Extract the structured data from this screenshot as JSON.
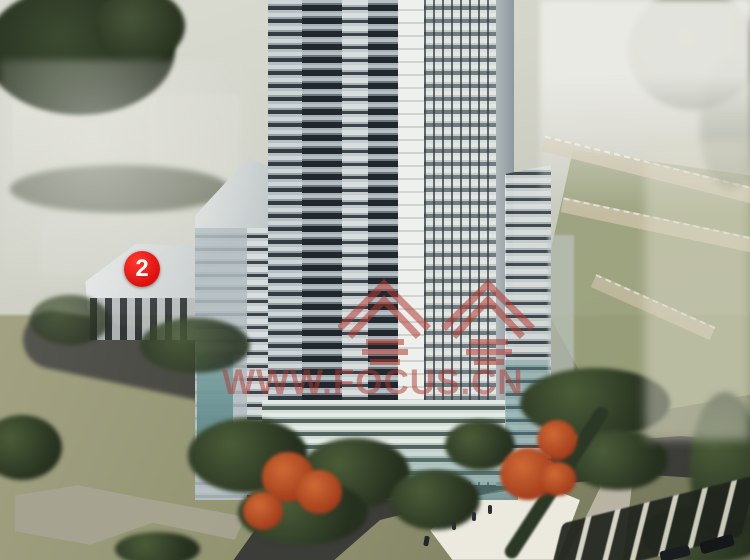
{
  "meta": {
    "title": "High-rise residential complex - aerial architectural rendering",
    "type": "real-estate rendering photo"
  },
  "annotation_marker": {
    "label": "2",
    "fill_color": "#dd0f0f",
    "text_color": "#ffffff"
  },
  "watermark": {
    "url_text": "WWW.FOCUS.CN",
    "logo_characters": "焦点",
    "logo_shape": "two-house-roof-outlines",
    "color": "#b23630"
  },
  "scene": {
    "description": "Aerial rendering: tall pale blue-grey residential tower in center, mid-rise annex buildings at left (annex labeled with red marker 2), landscaped gardens with green and red autumn trees, dark curving asphalt roads, white paved plaza with tiny pedestrians, diagonal parking row with dark cars at bottom right, hazy whitened urban backdrop at top corners.",
    "palette": {
      "tower_facade": "#c3cccf",
      "balcony_shadow": "#20282d",
      "glass_base_teal": "#6f9c9a",
      "lawn_olive": "#90926f",
      "road_asphalt": "#3e3e3a",
      "plaza_white": "#eceadf",
      "autumn_tree": "#b84a28",
      "green_tree": "#33402a",
      "haze": "#e9e9e3"
    }
  }
}
